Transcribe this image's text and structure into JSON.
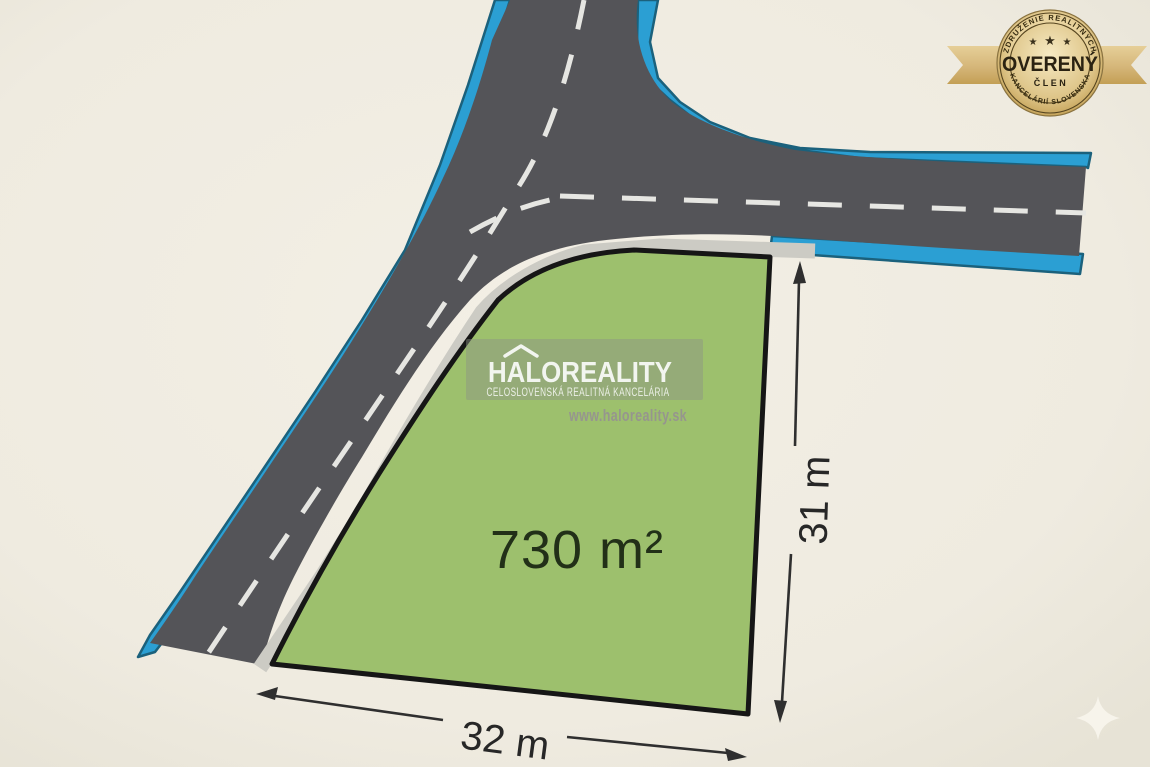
{
  "canvas": {
    "width": 1150,
    "height": 767
  },
  "colors": {
    "background": "#efebe0",
    "road_asphalt": "#545458",
    "road_edge_blue": "#2b9fd3",
    "curb_gray": "#cccbc4",
    "parcel_green": "#9dc06d",
    "parcel_outline": "#161616",
    "badge_gold": "#d7b872"
  },
  "parcel": {
    "area_label": "730 m²",
    "width_label": "32 m",
    "depth_label": "31 m"
  },
  "watermark": {
    "brand": "HALOREALITY",
    "tagline": "CELOSLOVENSKÁ REALITNÁ KANCELÁRIA",
    "website": "www.haloreality.sk"
  },
  "badge": {
    "arc_top": "ZDRUŽENIE REALITNÝCH",
    "arc_bottom": "KANCELÁRIÍ SLOVENSKA",
    "title": "OVERENÝ",
    "subtitle": "ČLEN",
    "star": "★"
  }
}
